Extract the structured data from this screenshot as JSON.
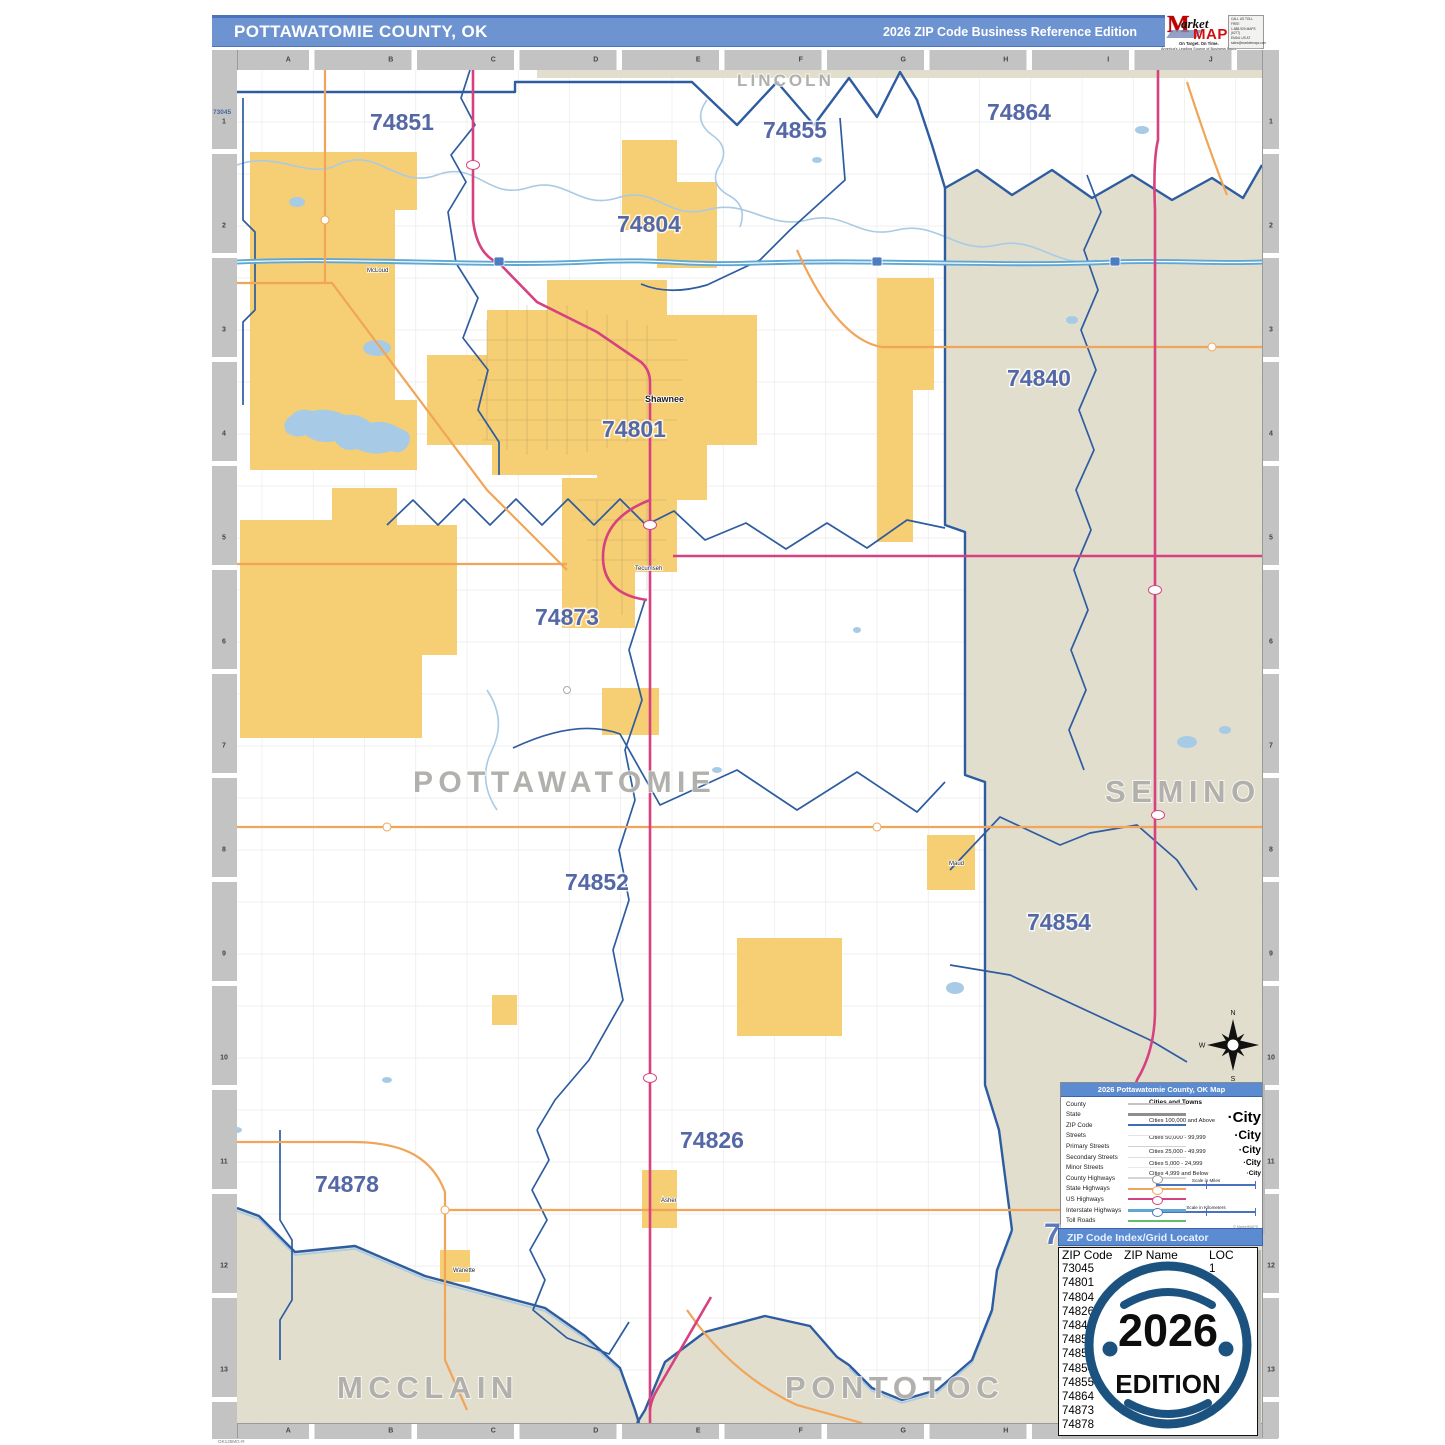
{
  "page": {
    "footer_code": "OK125MG-R"
  },
  "header": {
    "title": "POTTAWATOMIE COUNTY, OK",
    "edition": "2026 ZIP Code Business Reference Edition",
    "logo": {
      "market": "arket",
      "bigm": "M",
      "maps": "MAPS",
      "tagline": "On Target.  On Time.",
      "subline": "America's Leading Source of Business Maps",
      "code": "D123456",
      "contact_lines": [
        "CALL US TOLL FREE",
        "1-888-929-MAPS (6277)",
        "EMAIL US AT",
        "sales@marketmaps.com"
      ]
    }
  },
  "map": {
    "grid_letters": [
      "A",
      "B",
      "C",
      "D",
      "E",
      "F",
      "G",
      "H",
      "I",
      "J"
    ],
    "grid_numbers": [
      "1",
      "2",
      "3",
      "4",
      "5",
      "6",
      "7",
      "8",
      "9",
      "10",
      "11",
      "12",
      "13"
    ],
    "edge_zip": "73045",
    "county_labels": [
      {
        "name": "LINCOLN",
        "x": 500,
        "y": 16,
        "size": 17
      },
      {
        "name": "POTTAWATOMIE",
        "x": 176,
        "y": 722,
        "size": 30
      },
      {
        "name": "SEMINOLE",
        "x": 868,
        "y": 732,
        "size": 31
      },
      {
        "name": "MCCLAIN",
        "x": 100,
        "y": 1328,
        "size": 31
      },
      {
        "name": "PONTOTOC",
        "x": 548,
        "y": 1328,
        "size": 31
      }
    ],
    "zip_labels": [
      {
        "code": "74851",
        "x": 133,
        "y": 60
      },
      {
        "code": "74855",
        "x": 526,
        "y": 68
      },
      {
        "code": "74864",
        "x": 750,
        "y": 50
      },
      {
        "code": "74804",
        "x": 380,
        "y": 162
      },
      {
        "code": "74840",
        "x": 770,
        "y": 316
      },
      {
        "code": "74801",
        "x": 365,
        "y": 367
      },
      {
        "code": "74873",
        "x": 298,
        "y": 555
      },
      {
        "code": "74852",
        "x": 328,
        "y": 820
      },
      {
        "code": "74854",
        "x": 790,
        "y": 860
      },
      {
        "code": "74826",
        "x": 443,
        "y": 1078
      },
      {
        "code": "74878",
        "x": 78,
        "y": 1122
      }
    ],
    "town_labels": [
      {
        "name": "Shawnee",
        "x": 408,
        "y": 332,
        "size": 9,
        "weight": "bold"
      },
      {
        "name": "Tecumseh",
        "x": 398,
        "y": 500,
        "size": 6,
        "weight": "normal"
      },
      {
        "name": "McLoud",
        "x": 130,
        "y": 202,
        "size": 6,
        "weight": "normal"
      },
      {
        "name": "Maud",
        "x": 712,
        "y": 795,
        "size": 6,
        "weight": "normal"
      },
      {
        "name": "Asher",
        "x": 424,
        "y": 1132,
        "size": 6,
        "weight": "normal"
      },
      {
        "name": "Wanette",
        "x": 216,
        "y": 1202,
        "size": 6,
        "weight": "normal"
      }
    ],
    "compass": {
      "n": "N",
      "e": "E",
      "s": "S",
      "w": "W"
    }
  },
  "legend": {
    "title": "2026 Pottawatomie County, OK Map",
    "rows": [
      "County",
      "State",
      "ZIP Code",
      "Streets",
      "Primary Streets",
      "Secondary Streets",
      "Minor Streets",
      "County Highways",
      "State Highways",
      "US Highways",
      "Interstate Highways",
      "Toll Roads"
    ],
    "cities_title": "Cities and Towns",
    "city_classes": [
      {
        "label": "Cities 100,000 and Above",
        "sample": "·City",
        "size": 15
      },
      {
        "label": "Cities 50,000 - 99,999",
        "sample": "·City",
        "size": 12
      },
      {
        "label": "Cities 25,000 - 49,999",
        "sample": "·City",
        "size": 10
      },
      {
        "label": "Cities 5,000 - 24,999",
        "sample": "·City",
        "size": 8
      },
      {
        "label": "Cities 4,999 and Below",
        "sample": "·City",
        "size": 6.5
      }
    ],
    "scale_miles": "Scale in Miles",
    "scale_km": "Scale in Kilometers",
    "credit": "© MarketMAPS"
  },
  "zip_index": {
    "grid_digit": "7",
    "bar_title": "ZIP Code Index/Grid Locator",
    "columns": [
      "ZIP Code",
      "ZIP Name",
      "LOC"
    ],
    "rows": [
      {
        "zip": "73045",
        "name": "",
        "loc": "1"
      },
      {
        "zip": "74801",
        "name": "",
        "loc": ""
      },
      {
        "zip": "74804",
        "name": "",
        "loc": ""
      },
      {
        "zip": "74826",
        "name": "",
        "loc": ""
      },
      {
        "zip": "74840",
        "name": "",
        "loc": ""
      },
      {
        "zip": "74851",
        "name": "",
        "loc": ""
      },
      {
        "zip": "74852",
        "name": "",
        "loc": ""
      },
      {
        "zip": "74854",
        "name": "",
        "loc": ""
      },
      {
        "zip": "74855",
        "name": "",
        "loc": ""
      },
      {
        "zip": "74864",
        "name": "",
        "loc": ""
      },
      {
        "zip": "74873",
        "name": "",
        "loc": ""
      },
      {
        "zip": "74878",
        "name": "",
        "loc": ""
      }
    ]
  },
  "badge": {
    "year": "2026",
    "word": "EDITION"
  },
  "colors": {
    "header_blue": "#6E93D1",
    "zip_label": "#5568A6",
    "county_gray": "#B1B0AC",
    "beige": "#E2DECD",
    "yellow": "#F6CE73",
    "water": "#A7CBE6",
    "boundary": "#2D5CA0",
    "us_hwy": "#D6427F",
    "state_hwy": "#F0A558",
    "interstate": "#5FA8D5",
    "badge_blue": "#1C527F"
  }
}
